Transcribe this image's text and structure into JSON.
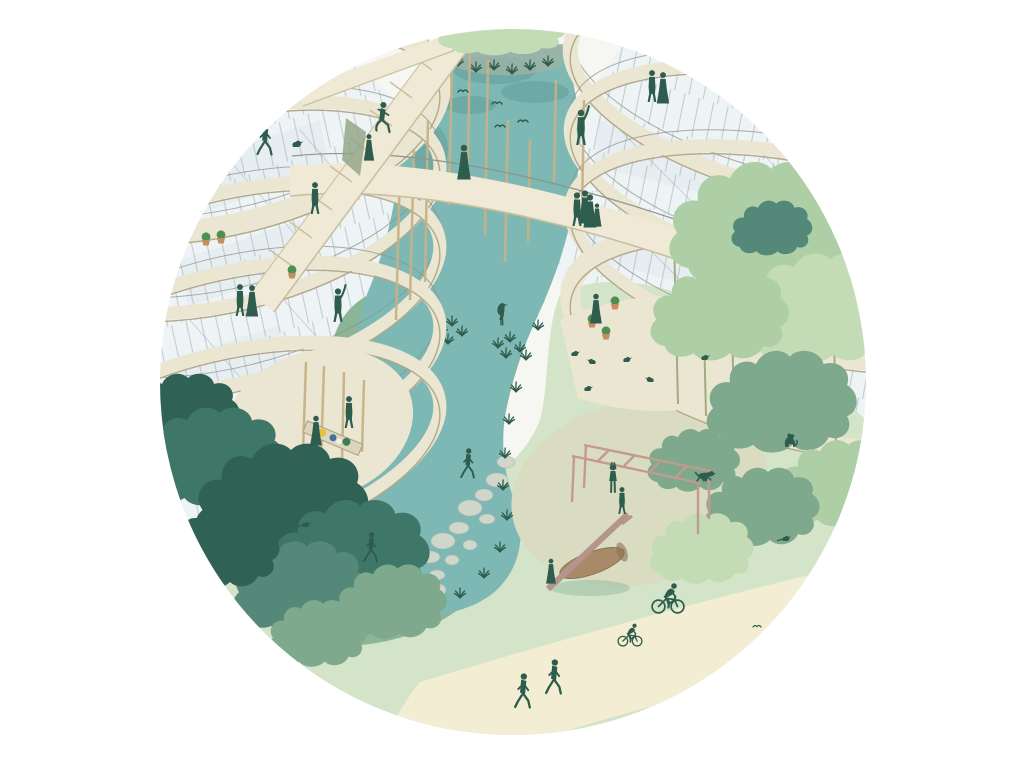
{
  "meta": {
    "description": "Circular architectural vignette illustration: two curved multi-storey timber-and-glass buildings with stacked balcony rings face each other across a teal pond; stilted walkways and a ramp bridge the water; below, a park with lawns, stepping stones through tall grass, a playground with monkey bars and a log seesaw, dense trees, cyclists and pedestrians on a sand-coloured path, dogs and birds.",
    "canvas": {
      "width": 1027,
      "height": 766
    }
  },
  "palette": {
    "bg": "#ffffff",
    "base": "#f6f7f3",
    "glass": "#eef3f6",
    "glassPanel": "#dfe9ee",
    "mullion": "#98a3a4",
    "band": "#ebe6d2",
    "bandEdge": "#b3a887",
    "railing": "#8e9489",
    "bridge": "#efe9d5",
    "bridgeEdge": "#c9bf9e",
    "stilt": "#c6b286",
    "trunk": "#9aa57b",
    "water": "#7db8b4",
    "reflection": "#5f9894",
    "reed": "#9fb3a6",
    "reedOlive": "#90a183",
    "lawn": "#d3e4c9",
    "grassband": "#8cb497",
    "grassdark": "#55876d",
    "grasslight": "#a9cba8",
    "oval": "#d9dcc0",
    "path": "#f2edd3",
    "treeDark1": "#3e7668",
    "treeDark2": "#2f6254",
    "treeDark3": "#54897a",
    "treeMid": "#7fa98c",
    "treeLight1": "#aecfa6",
    "treeLight2": "#c3dcb6",
    "figure": "#2e5c4d",
    "play": "#c29a90",
    "log": "#a98a68",
    "logEdge": "#8a7355",
    "plank": "#b5958b",
    "pot": "#c78d5e",
    "plant": "#4e8f54",
    "stone": "#cfd6ca",
    "stoneEdge": "#aeb8ab",
    "table": "#ddd6bd",
    "tableEdge": "#a99f83",
    "accentYellow": "#e0c23c",
    "accentBlue": "#3e6f9e",
    "accentGreen": "#3f7d53",
    "shadow": "#5d8f77"
  },
  "scene": {
    "vignette_shape": "circle",
    "areas": [
      {
        "name": "left-building",
        "desc": "curved glass building, 5 balcony rings, people and potted plants"
      },
      {
        "name": "right-building",
        "desc": "curved glass building, 4 balcony rings, trees growing through"
      },
      {
        "name": "pond",
        "desc": "S-shaped teal pond between the buildings"
      },
      {
        "name": "lawn",
        "desc": "light green park lawn"
      },
      {
        "name": "playground",
        "desc": "sand oval with monkey bars and log seesaw"
      },
      {
        "name": "footpath",
        "desc": "cream diagonal path with walkers and cyclists"
      },
      {
        "name": "stepping-stones",
        "desc": "stone trail through tall marsh grass"
      },
      {
        "name": "bridges",
        "desc": "stilted walkway, steep ramp and upper link between buildings"
      }
    ],
    "counts": {
      "people": 27,
      "cyclists": 2,
      "dogs": 2,
      "flying_birds": 5,
      "ground_birds": 8,
      "heron": 1,
      "potted_plants": 6,
      "stepping_stones": 15
    }
  }
}
